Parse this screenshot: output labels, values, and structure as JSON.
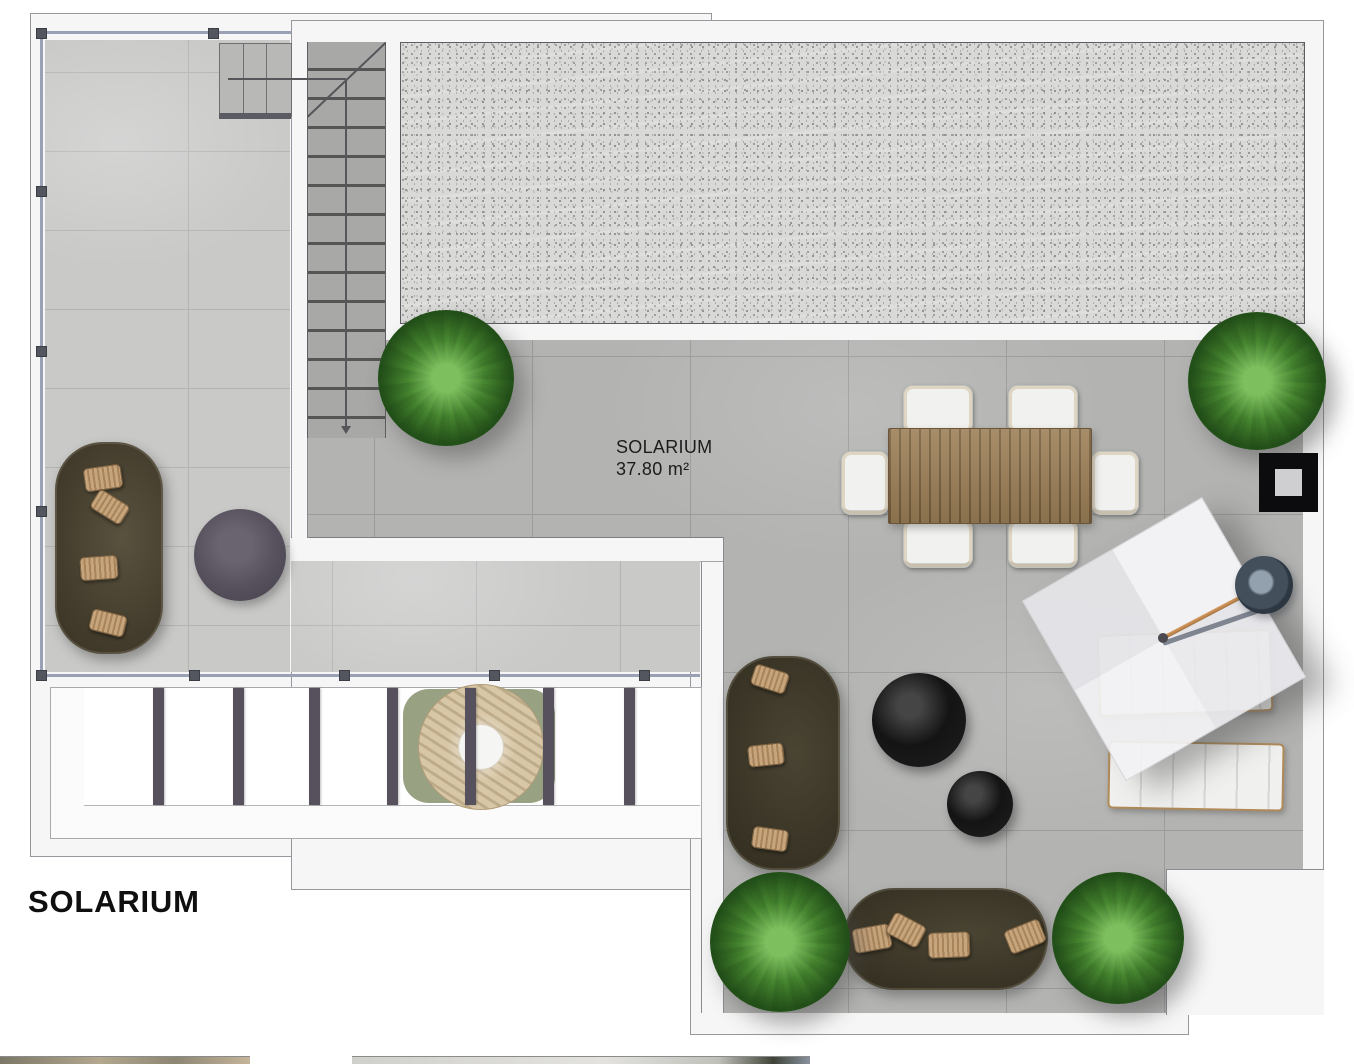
{
  "plan": {
    "title": "SOLARIUM",
    "room_label": {
      "name": "SOLARIUM",
      "area": "37.80 m²"
    }
  },
  "furniture": [
    {
      "name": "staircase",
      "location": "upper-left"
    },
    {
      "name": "gravel-roof",
      "location": "top"
    },
    {
      "name": "glass-railing",
      "location": "left-terrace"
    },
    {
      "name": "lounge-sofa",
      "location": "left-terrace"
    },
    {
      "name": "round-side-table",
      "location": "left-terrace"
    },
    {
      "name": "dining-table-6-chairs",
      "location": "center"
    },
    {
      "name": "cantilever-parasol",
      "location": "right"
    },
    {
      "name": "sun-lounger",
      "count": 2,
      "location": "right"
    },
    {
      "name": "round-coffee-table-black",
      "count": 2,
      "location": "lower-terrace"
    },
    {
      "name": "outdoor-sofa",
      "count": 2,
      "location": "lower-terrace"
    },
    {
      "name": "planter-bush",
      "count": 4
    },
    {
      "name": "pergola-with-dining-set",
      "location": "bottom-left"
    },
    {
      "name": "chimney",
      "location": "right-edge"
    }
  ],
  "colors": {
    "light_tiles": "#c9c9c8",
    "dark_tiles": "#b3b4b2",
    "gravel": "#d9d9d7",
    "sofa_olive": "#443d2d",
    "pillow_tan": "#b8946a",
    "wood": "#9d8057",
    "plant_green": "#3e7629",
    "railing": "#9ba1b4",
    "parasol_white": "#f2f2f4"
  }
}
